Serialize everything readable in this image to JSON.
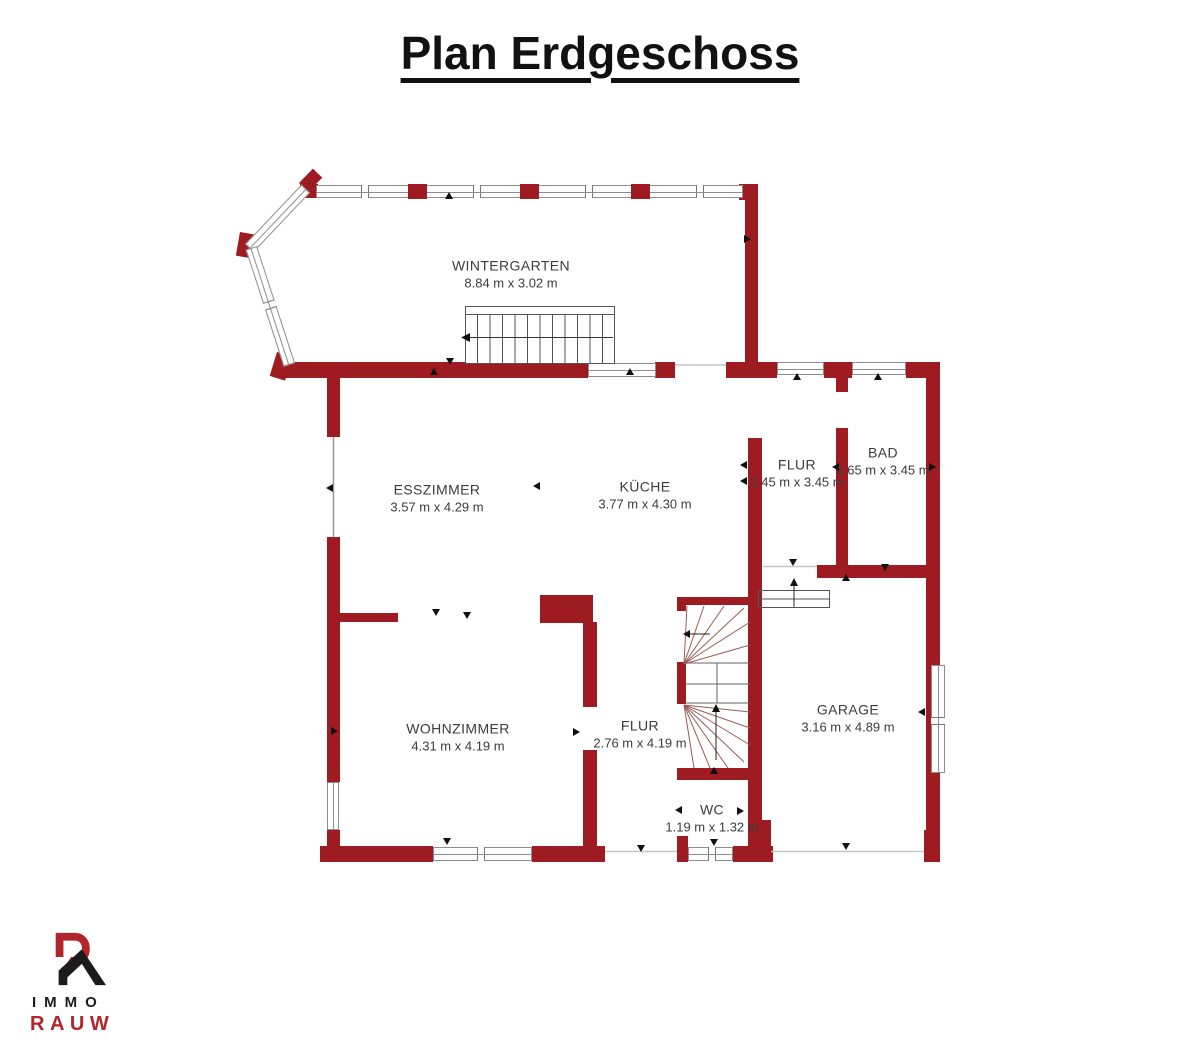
{
  "page": {
    "title": "Plan Erdgeschoss"
  },
  "colors": {
    "wall_red": "#9e1c21",
    "logo_red": "#b2252b",
    "label_text": "#3c3c3c",
    "title_text": "#111111"
  },
  "rooms": [
    {
      "id": "wintergarten",
      "name": "WINTERGARTEN",
      "dims": "8.84 m x 3.02 m"
    },
    {
      "id": "esszimmer",
      "name": "ESSZIMMER",
      "dims": "3.57 m x 4.29 m"
    },
    {
      "id": "kueche",
      "name": "KÜCHE",
      "dims": "3.77 m x 4.30 m"
    },
    {
      "id": "flur-og",
      "name": "FLUR",
      "dims": "1.45 m x 3.45 m"
    },
    {
      "id": "bad",
      "name": "BAD",
      "dims": "1.65 m x 3.45 m"
    },
    {
      "id": "wohnzimmer",
      "name": "WOHNZIMMER",
      "dims": "4.31 m x 4.19 m"
    },
    {
      "id": "flur-eg",
      "name": "FLUR",
      "dims": "2.76 m x 4.19 m"
    },
    {
      "id": "garage",
      "name": "GARAGE",
      "dims": "3.16 m x 4.89 m"
    },
    {
      "id": "wc",
      "name": "WC",
      "dims": "1.19 m x 1.32 m"
    }
  ],
  "logo": {
    "line1": "IMMO",
    "line2": "RAUW"
  }
}
